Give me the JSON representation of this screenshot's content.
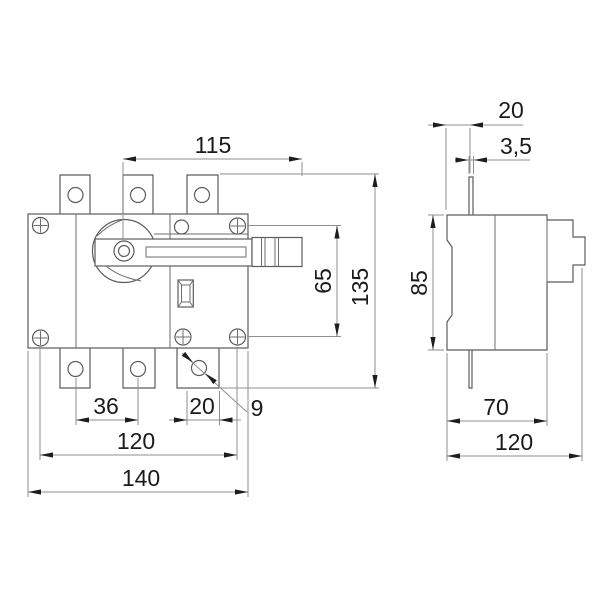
{
  "drawing": {
    "front_view": {
      "handle_length": "115",
      "mounting_height": "65",
      "overall_height": "135",
      "pole_spacing": "36",
      "terminal_width": "20",
      "terminal_hole": "9",
      "mounting_width": "120",
      "overall_width": "140"
    },
    "side_view": {
      "clip_offset": "20",
      "pin_width": "3,5",
      "body_height": "85",
      "body_depth": "70",
      "overall_depth": "120"
    }
  }
}
